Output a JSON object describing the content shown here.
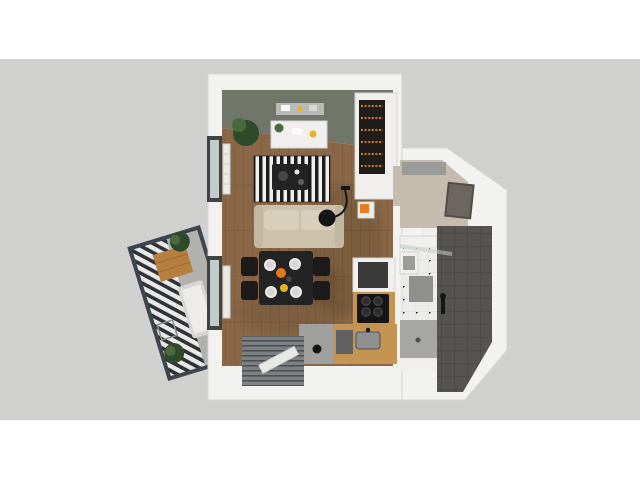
{
  "scene": {
    "type": "apartment-floor-plan-3d-render",
    "view": "top-down",
    "rooms": [
      "living-room",
      "dining-area",
      "kitchen",
      "hallway",
      "bathroom",
      "balcony",
      "entry"
    ],
    "objects": [
      "sofa",
      "area-rug",
      "coffee-table",
      "arc-floor-lamp",
      "console-table",
      "wall-shelf",
      "potted-plant",
      "wine-rack",
      "orange-label-box",
      "dining-table",
      "dining-chair",
      "plate",
      "serving-dish",
      "kitchen-counter",
      "cooktop",
      "oven-cabinet",
      "kitchen-sink",
      "dishwasher",
      "kettle",
      "hall-cabinet",
      "wall-mirror",
      "bathroom-vanity",
      "bathroom-cabinet",
      "bath-mat",
      "shower-floor",
      "shower-fixture",
      "shower-glass",
      "dark-tile-wall",
      "balcony-bench",
      "lounge-chair",
      "balcony-plant",
      "wire-table",
      "window",
      "radiator",
      "entry-mat",
      "entry-door"
    ]
  },
  "palette": {
    "bg": "#d0d0cf",
    "frame": "#ffffff",
    "wall": "#f2f2f0",
    "wall_edge": "#d6d6d4",
    "accent_wall": "#70766a",
    "wood": "#8a6847",
    "wood_line": "#7a583b",
    "hall_floor": "#c6bcae",
    "tile": "#ececea",
    "tile_line": "#dbdbd9",
    "tile_dot": "#2a2a2a",
    "shower": "#a6a6a4",
    "mat": "#8f8f8d",
    "dark_tile": "#565450",
    "dark_tile_line": "#454440",
    "deck_dark": "#2e3236",
    "deck_light": "#e9e9e7",
    "deck_border": "#3d444b",
    "concrete": "#b3b1ad",
    "bench": "#b67f3e",
    "bench_line": "#9a6a32",
    "counter_wood": "#c49552",
    "counter_gray": "#a0a09e",
    "cabinet": "#f0efed",
    "oven_front": "#3a3a38",
    "sofa": "#ccc1ab",
    "sofa_cushion": "#d8cfbb",
    "sofa_arm": "#c2b7a1",
    "rug_dark": "#1c1c1c",
    "rug_light": "#efefed",
    "table_black": "#232323",
    "chair_black": "#1b1b1b",
    "plate": "#e9e9e7",
    "plate_inner": "#d5d5d3",
    "food_orange": "#e07818",
    "food_yellow": "#eab31e",
    "bottle_dark": "#201d19",
    "bottle_cap": "#c87b2a",
    "label_orange": "#e87c1e",
    "plant": "#2f4a2b",
    "plant_light": "#4a6a3c",
    "lamp": "#151515",
    "appliance": "#5f6163",
    "sink_steel": "#8d8f90",
    "mirror": "#6b6760",
    "mirror_frame": "#514e48",
    "window_frame": "#3f4345",
    "glass": "#c3cbcb",
    "shelf_gray": "#b9b9b7",
    "hall_cabinet": "#9b9b99",
    "steel": "#7e8184",
    "steel_dark": "#4e5154",
    "door_leaf": "#e8e8e6",
    "shadow": "#000000",
    "cooktop": "#161616",
    "burner": "#2e2e2e",
    "burner_ring": "#484848",
    "paper": "#fafaf8",
    "radiator": "#e9e9e7",
    "radiator_line": "#cfcfcd",
    "lounge": "#d7d6d2",
    "lounge_cushion": "#edece8",
    "wire": "#8d9092"
  }
}
